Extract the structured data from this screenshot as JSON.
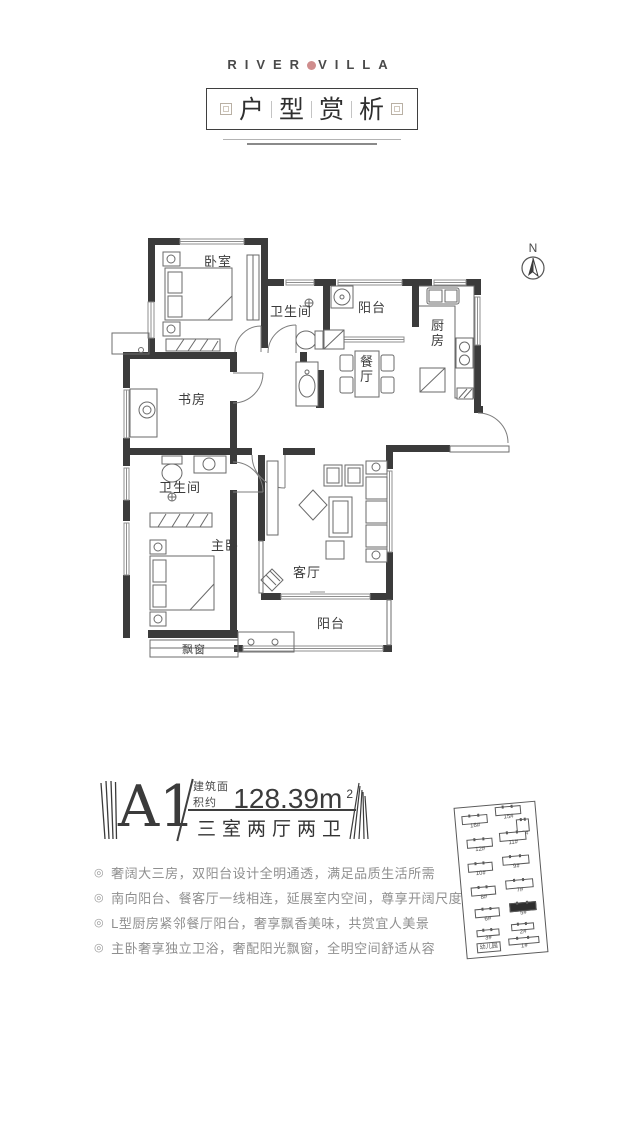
{
  "colors": {
    "ink": "#3b3b3b",
    "brand_seal": "#cf8d8d",
    "feature_text": "#8f8f8f"
  },
  "brand": {
    "left": "RIVER",
    "right": "VILLA"
  },
  "title": {
    "chars": [
      "户",
      "型",
      "赏",
      "析"
    ]
  },
  "compass": {
    "label": "N"
  },
  "floorplan": {
    "rooms": [
      {
        "name": "卧室"
      },
      {
        "name": "卫生间"
      },
      {
        "name": "阳台"
      },
      {
        "name": "厨房"
      },
      {
        "name": "餐厅"
      },
      {
        "name": "书房"
      },
      {
        "name": "卫生间"
      },
      {
        "name": "主卧"
      },
      {
        "name": "客厅"
      },
      {
        "name": "阳台"
      },
      {
        "name": "飘窗"
      }
    ]
  },
  "unit": {
    "name": "A1",
    "area_label": "建筑面积约",
    "area_value": "128.39m",
    "area_sup": "2",
    "layout": "三室两厅两卫"
  },
  "bullet_icon": "◎",
  "features": [
    "奢阔大三房，双阳台设计全明通透，满足品质生活所需",
    "南向阳台、餐客厅一线相连，延展室内空间，尊享开阔尺度",
    "L型厨房紧邻餐厅阳台，奢享飘香美味，共赏宜人美景",
    "主卧奢享独立卫浴，奢配阳光飘窗，全明空间舒适从容"
  ],
  "sitemap": {
    "buildings": [
      {
        "label": "16#",
        "x": 6,
        "y": 8,
        "w": 26,
        "h": 9
      },
      {
        "label": "15#",
        "x": 40,
        "y": 2,
        "w": 26,
        "h": 9
      },
      {
        "label": "13#",
        "x": 60,
        "y": 16,
        "w": 13,
        "h": 13
      },
      {
        "label": "12#",
        "x": 9,
        "y": 32,
        "w": 26,
        "h": 9
      },
      {
        "label": "11#",
        "x": 42,
        "y": 28,
        "w": 27,
        "h": 9
      },
      {
        "label": "10#",
        "x": 8,
        "y": 56,
        "w": 25,
        "h": 9
      },
      {
        "label": "9#",
        "x": 43,
        "y": 52,
        "w": 27,
        "h": 9
      },
      {
        "label": "8#",
        "x": 9,
        "y": 80,
        "w": 25,
        "h": 9
      },
      {
        "label": "7#",
        "x": 44,
        "y": 76,
        "w": 28,
        "h": 9
      },
      {
        "label": "6#",
        "x": 11,
        "y": 102,
        "w": 25,
        "h": 9
      },
      {
        "label": "5#",
        "x": 46,
        "y": 99,
        "w": 27,
        "h": 9,
        "highlight": true
      },
      {
        "label": "3#",
        "x": 11,
        "y": 123,
        "w": 23,
        "h": 7
      },
      {
        "label": "2#",
        "x": 46,
        "y": 120,
        "w": 23,
        "h": 7
      },
      {
        "label": "幼儿园",
        "x": 10,
        "y": 136,
        "w": 24,
        "h": 10,
        "boxed": true
      },
      {
        "label": "1#",
        "x": 42,
        "y": 134,
        "w": 31,
        "h": 7
      }
    ]
  }
}
